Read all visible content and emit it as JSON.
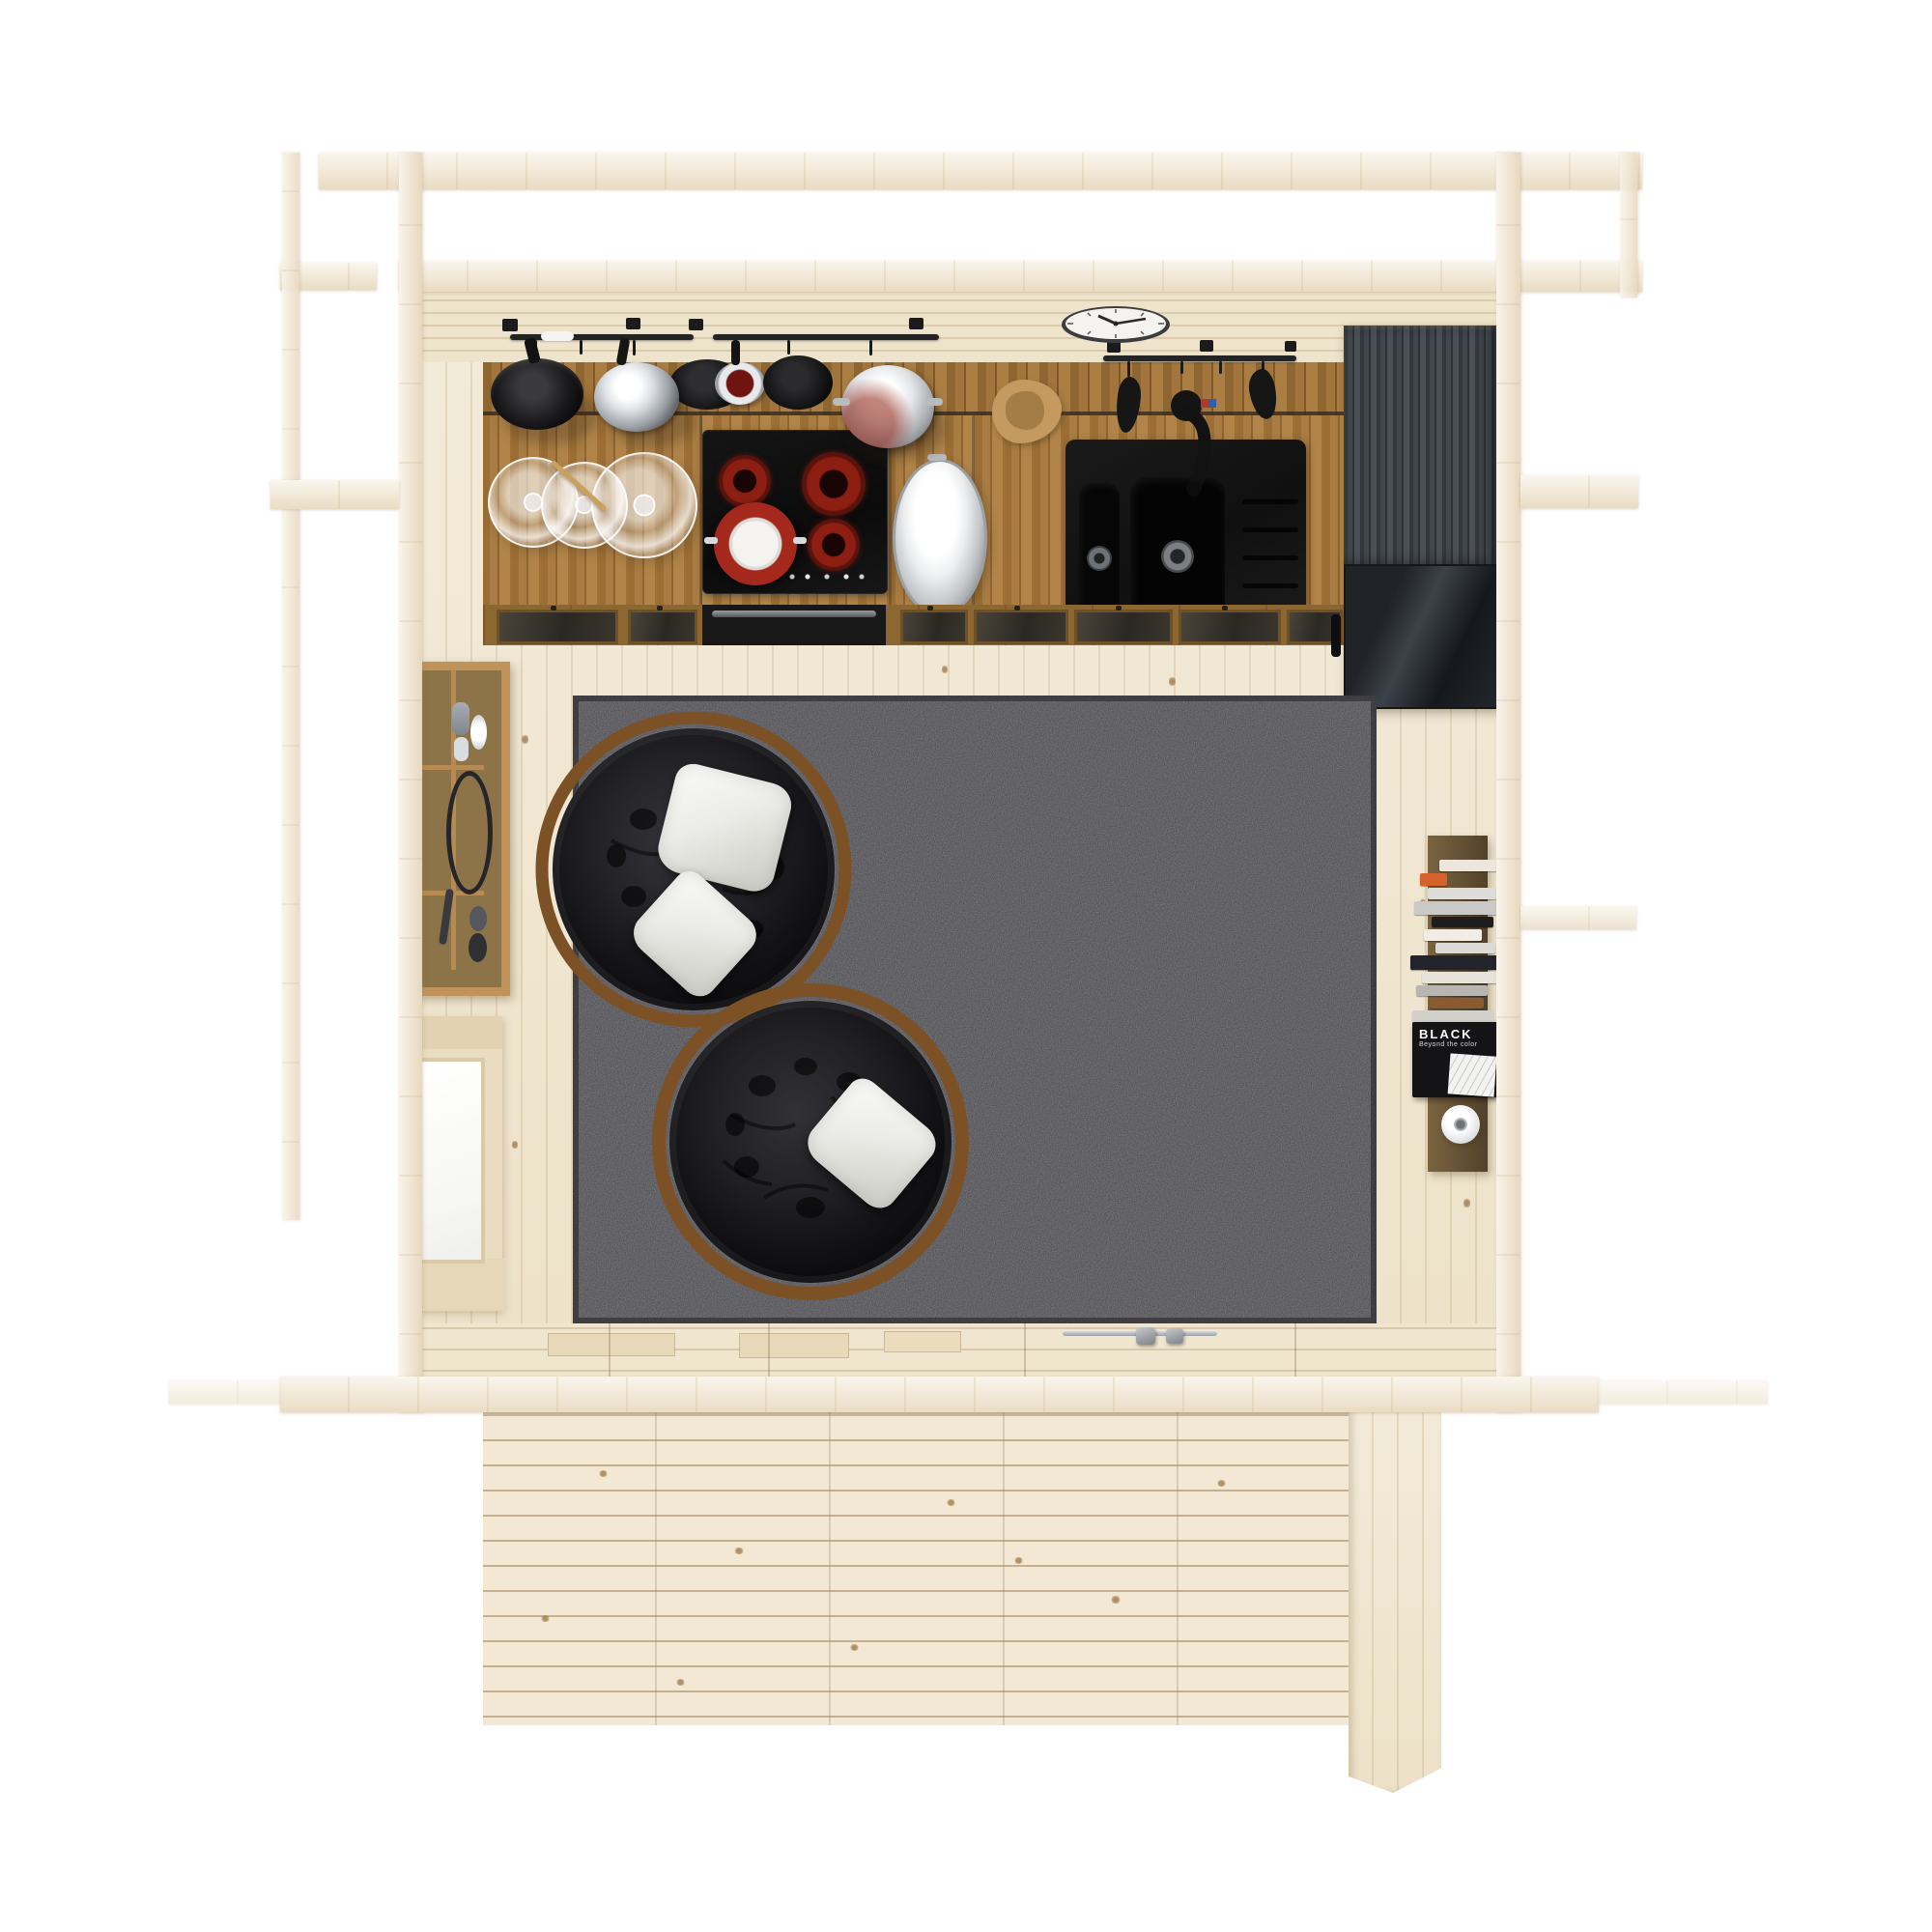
{
  "meta": {
    "description": "Top-down 3D render of a compact wooden cabin interior: kitchenette with hob, sink and fridge along the back wall, hanging pot rails, wall clock, two black papasan chairs with white pillows on a dark grey shag rug, wall shelf with decor, side window, vertical bookshelf with a white vase, and a plank deck terrace in front."
  },
  "palette": {
    "background": "#ffffff",
    "pine_light": "#efe5ce",
    "oak_counter": "#a67a40",
    "appliance_black": "#141414",
    "burner_red": "#8c1f12",
    "rug_gray": "#46464b",
    "fridge_gray": "#3f434a",
    "rattan_brown": "#7c5126",
    "pillow_white": "#ebebe7",
    "steel": "#d9dcde"
  },
  "clock": {
    "time": "10:10"
  },
  "kitchen": {
    "hob_burners": 4,
    "sink_bowls": 2,
    "hanging_pots": 6
  },
  "bookshelf": {
    "featured_book": {
      "title": "BLACK",
      "subtitle": "Beyond the color"
    },
    "books": [
      {
        "ml": 30,
        "w": 60,
        "h": 12,
        "c": "#ece6dd"
      },
      {
        "ml": 10,
        "w": 28,
        "h": 13,
        "c": "#d4622a"
      },
      {
        "ml": 18,
        "w": 74,
        "h": 12,
        "c": "#dddcd8"
      },
      {
        "ml": 4,
        "w": 86,
        "h": 14,
        "c": "#c9c9c7"
      },
      {
        "ml": 22,
        "w": 64,
        "h": 11,
        "c": "#1d1d1f"
      },
      {
        "ml": 14,
        "w": 60,
        "h": 12,
        "c": "#f1ece4"
      },
      {
        "ml": 26,
        "w": 62,
        "h": 11,
        "c": "#dcdad5"
      },
      {
        "ml": 0,
        "w": 92,
        "h": 15,
        "c": "#23232b"
      },
      {
        "ml": 12,
        "w": 80,
        "h": 12,
        "c": "#e7e3da"
      },
      {
        "ml": 6,
        "w": 74,
        "h": 11,
        "c": "#b9b6b1"
      },
      {
        "ml": 20,
        "w": 56,
        "h": 11,
        "c": "#8a5a30"
      },
      {
        "ml": 2,
        "w": 84,
        "h": 13,
        "c": "#d2d0cb"
      },
      {
        "ml": 10,
        "w": 62,
        "h": 11,
        "c": "#17171a"
      },
      {
        "ml": 16,
        "w": 70,
        "h": 11,
        "c": "#e3dfd6"
      }
    ]
  }
}
